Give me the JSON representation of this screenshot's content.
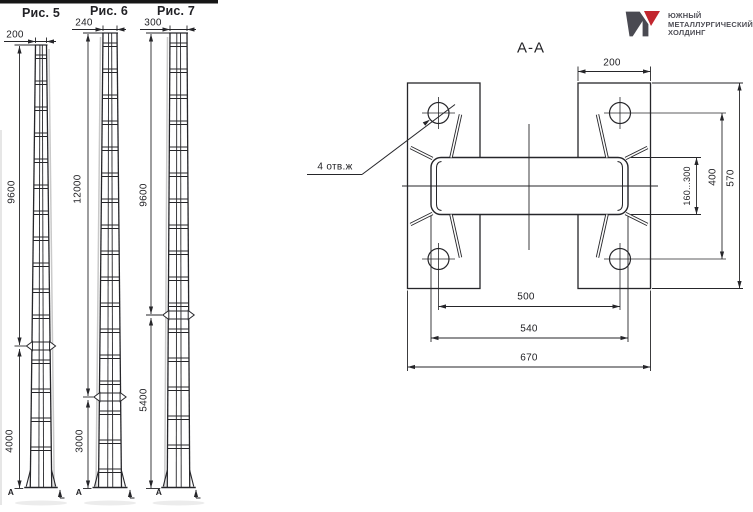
{
  "figures": [
    {
      "title": "Рис. 5",
      "top_width": "200",
      "upper": "9600",
      "lower": "4000",
      "mark": "А"
    },
    {
      "title": "Рис. 6",
      "top_width": "240",
      "upper": "12000",
      "lower": "3000",
      "mark": "А"
    },
    {
      "title": "Рис. 7",
      "top_width": "300",
      "upper": "9600",
      "lower": "5400",
      "mark": "А"
    }
  ],
  "section": {
    "title": "А-А",
    "leader_note": "4 отв.ж",
    "plate_width": "200",
    "overall_height": "570",
    "hole_span_v": "400",
    "tube_height": "160...300",
    "hole_span_h": "500",
    "tube_length": "540",
    "overall_width": "670"
  },
  "logo": {
    "line1": "ЮЖНЫЙ",
    "line2": "МЕТАЛЛУРГИЧЕСКИЙ",
    "line3": "ХОЛДИНГ",
    "dark_color": "#4a4a52",
    "red_color": "#c2262e"
  }
}
